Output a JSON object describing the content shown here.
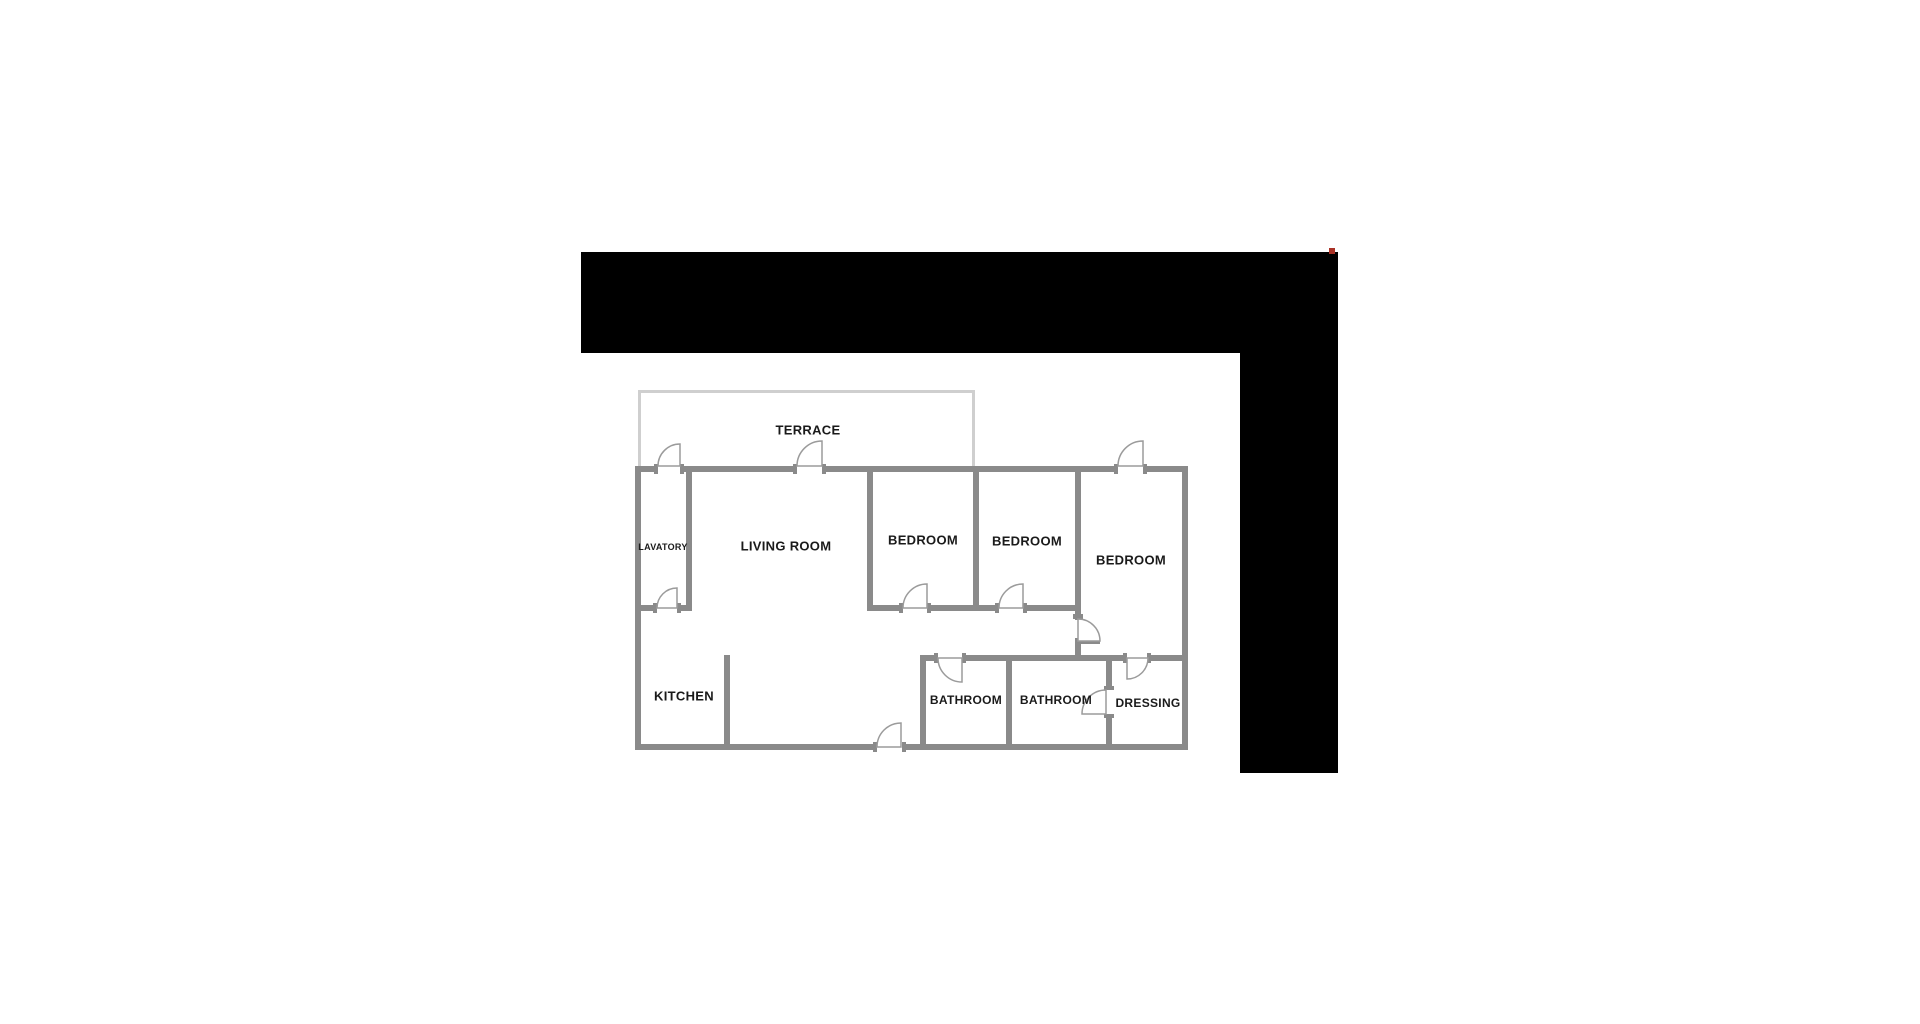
{
  "brand": {
    "name_primary": "CASTILLO",
    "name_secondary": "HOMES",
    "tagline": "REAL ESTATE"
  },
  "header": {
    "plan_code": "CH1252"
  },
  "colors": {
    "banner_bg": "#000000",
    "wall": "#8a8a8a",
    "terrace_wall": "#cfcfcf",
    "door_arc": "#9b9b9b",
    "label_text": "#1a1a1a",
    "logo_primary": "#ffffff",
    "logo_secondary": "#d6d6d6",
    "tagline_color": "#8f8f8f",
    "red_dot": "#a93226"
  },
  "rooms": [
    {
      "name": "TERRACE",
      "x": 808,
      "y": 430,
      "size": 13
    },
    {
      "name": "LAVATORY",
      "x": 663,
      "y": 547,
      "size": 9
    },
    {
      "name": "LIVING ROOM",
      "x": 786,
      "y": 546,
      "size": 13
    },
    {
      "name": "BEDROOM",
      "x": 923,
      "y": 540,
      "size": 13
    },
    {
      "name": "BEDROOM",
      "x": 1027,
      "y": 541,
      "size": 13
    },
    {
      "name": "BEDROOM",
      "x": 1131,
      "y": 560,
      "size": 13
    },
    {
      "name": "KITCHEN",
      "x": 684,
      "y": 696,
      "size": 13
    },
    {
      "name": "BATHROOM",
      "x": 966,
      "y": 700,
      "size": 12
    },
    {
      "name": "BATHROOM",
      "x": 1056,
      "y": 700,
      "size": 12
    },
    {
      "name": "DRESSING",
      "x": 1148,
      "y": 703,
      "size": 12
    }
  ]
}
